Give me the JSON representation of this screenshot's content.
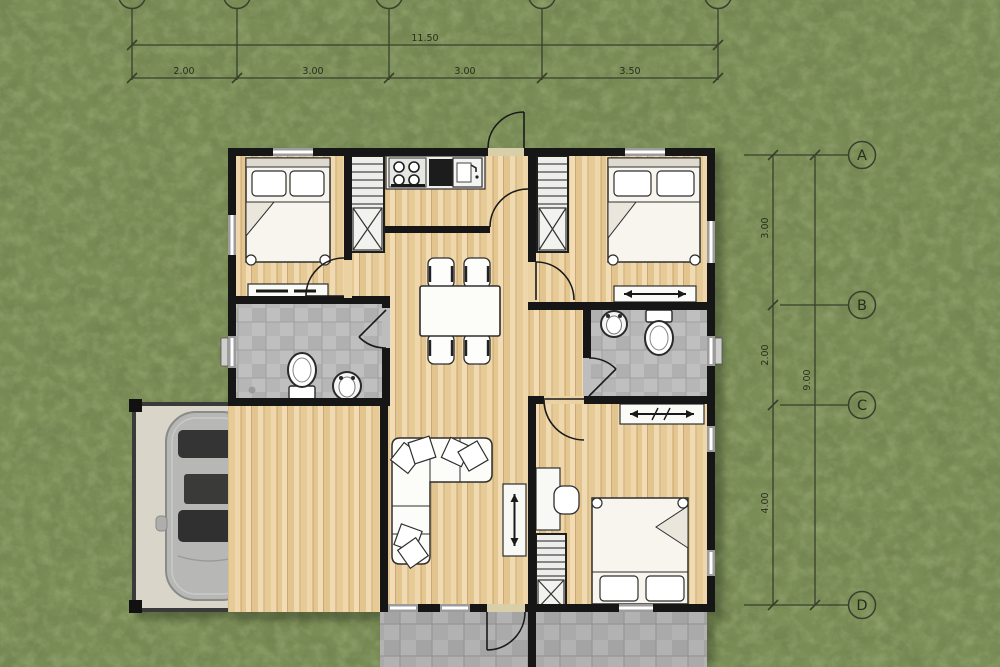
{
  "plan": {
    "dim_top_total": "11.50",
    "dim_top_segments": [
      "2.00",
      "3.00",
      "3.00",
      "3.50"
    ],
    "dim_right_segments": [
      "3.00",
      "2.00",
      "4.00"
    ],
    "dim_right_total": "9.00",
    "grid_rows": [
      "A",
      "B",
      "C",
      "D"
    ],
    "colors": {
      "grass": "#7C8F58",
      "wood_floor": "#ECD4A6",
      "wall": "#161616",
      "bath_tile": "#BFBFBF",
      "porch_tile": "#B2B2B2",
      "garage_floor": "#D9D5C9",
      "dimension_line": "#39402C"
    }
  }
}
